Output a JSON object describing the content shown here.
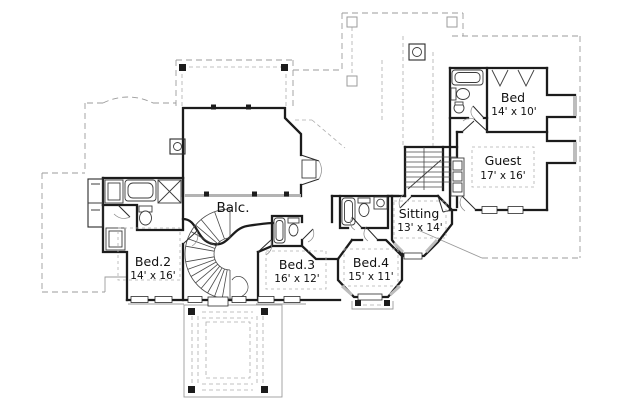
{
  "plan": {
    "drawing_type": "second-floor residential floor plan",
    "rooms": [
      {
        "name": "Balc.",
        "dims": ""
      },
      {
        "name": "Bed.2",
        "dims": "14' x 16'"
      },
      {
        "name": "Bed.3",
        "dims": "16' x 12'"
      },
      {
        "name": "Bed.4",
        "dims": "15' x 11'"
      },
      {
        "name": "Sitting",
        "dims": "13' x 14'"
      },
      {
        "name": "Guest",
        "dims": "17' x 16'"
      },
      {
        "name": "Bed",
        "dims": "14' x 10'"
      }
    ],
    "colors": {
      "wall": "#1c1c1c",
      "roof_dash": "#9b9b9b",
      "glass": "#bdbdbd",
      "railing": "#b3b3b3",
      "background": "#ffffff"
    },
    "icons": [
      "bathtub-icon",
      "toilet-icon",
      "sink-icon",
      "shower-icon",
      "closet-shelves-icon",
      "hanging-rod-icon",
      "chimney-icon",
      "spiral-stair-icon",
      "stair-icon",
      "door-swing-icon",
      "window-icon",
      "column-post-icon"
    ]
  }
}
